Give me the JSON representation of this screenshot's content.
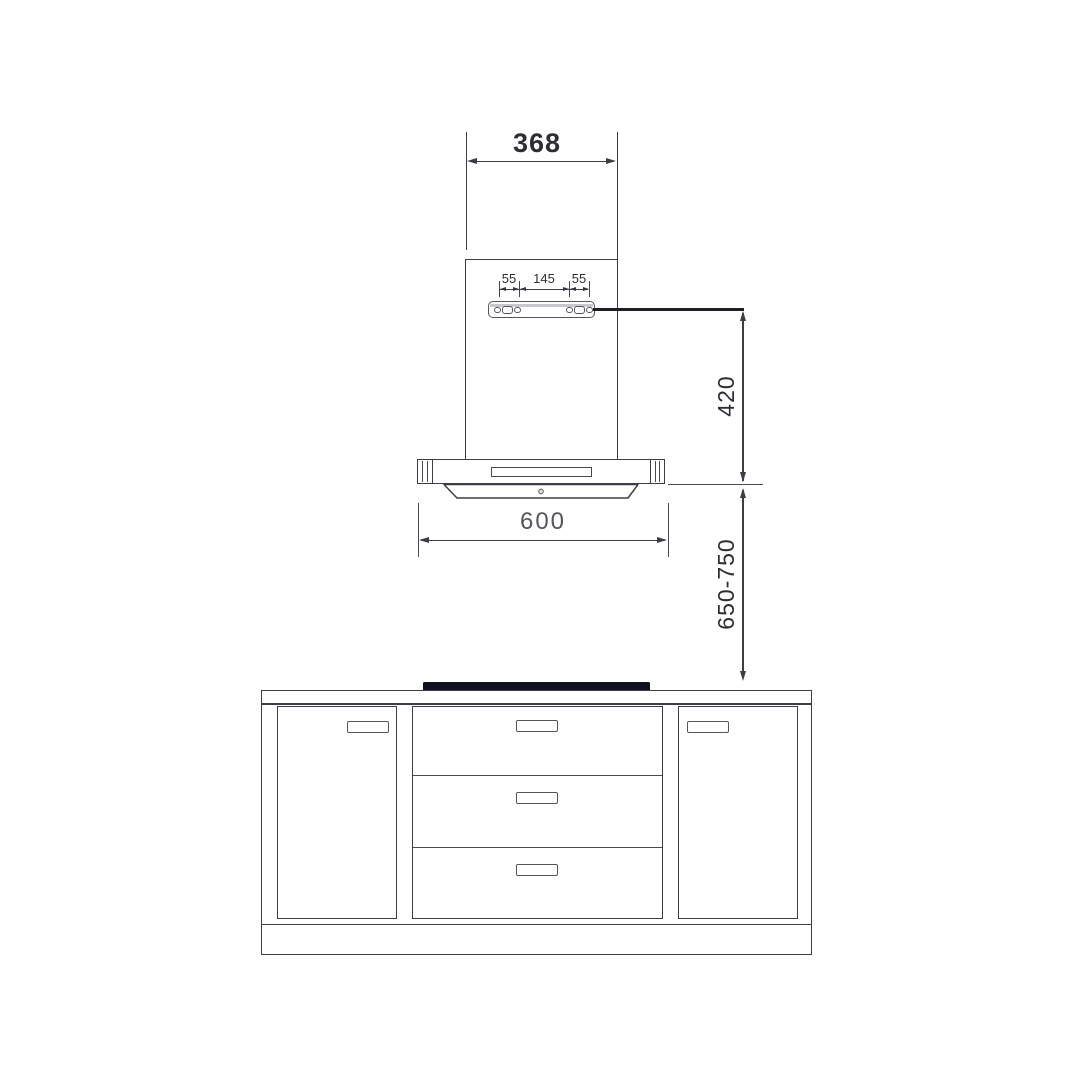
{
  "colors": {
    "line": "#3d3d45",
    "leader_line": "#1e1e24",
    "cooktop": "#0f1120",
    "dim_text": "#2d2d33",
    "dim_text_light": "#55555b"
  },
  "dims": {
    "chimney_width": "368",
    "bracket_left_offset": "55",
    "bracket_hole_spacing": "145",
    "bracket_right_offset": "55",
    "bracket_to_hood_bottom": "420",
    "hood_width": "600",
    "hood_to_hob_clearance": "650-750"
  }
}
